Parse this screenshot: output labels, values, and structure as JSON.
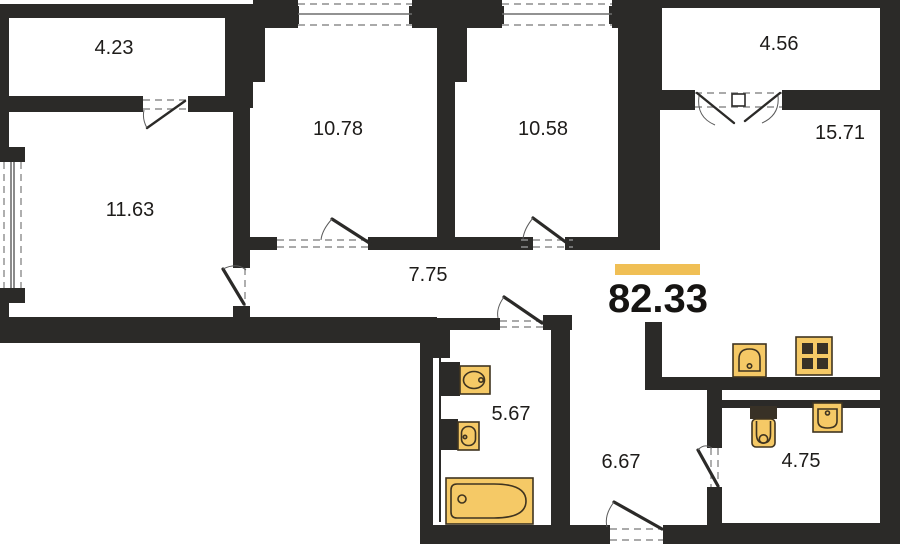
{
  "plan": {
    "total_area_label": "82.33",
    "rooms": [
      {
        "name": "balcony-left",
        "area": "4.23"
      },
      {
        "name": "room-1",
        "area": "10.78"
      },
      {
        "name": "room-2",
        "area": "10.58"
      },
      {
        "name": "balcony-right",
        "area": "4.56"
      },
      {
        "name": "kitchen-living-room",
        "area": "15.71"
      },
      {
        "name": "room-3",
        "area": "11.63"
      },
      {
        "name": "corridor",
        "area": "7.75"
      },
      {
        "name": "bathroom",
        "area": "5.67"
      },
      {
        "name": "hallway",
        "area": "6.67"
      },
      {
        "name": "wc",
        "area": "4.75"
      }
    ],
    "fixtures": [
      "bathtub",
      "washbasin-large",
      "washbasin-small",
      "kitchen-sink",
      "stove-4-burner",
      "toilet",
      "wc-washbasin"
    ],
    "colors": {
      "wall": "#2b2a28",
      "accent": "#f0bf55",
      "fixture": "#f5c966",
      "background": "#ffffff"
    }
  }
}
